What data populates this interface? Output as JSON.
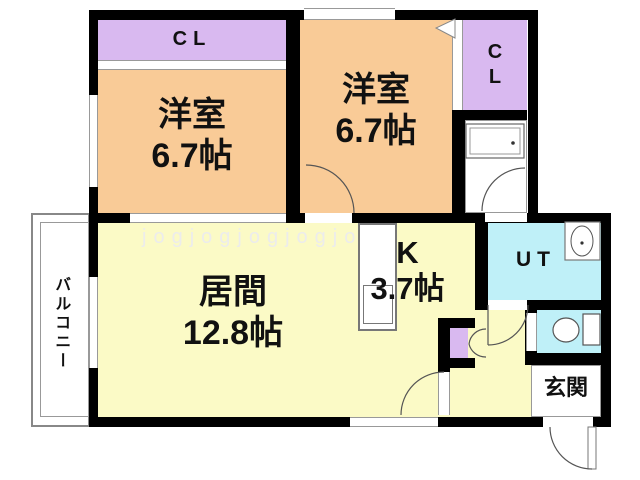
{
  "watermark": "jogjogjogjogjo",
  "rooms": {
    "closet_top": {
      "label": "CL"
    },
    "bedroom_left": {
      "name": "洋室",
      "size": "6.7帖"
    },
    "bedroom_right": {
      "name": "洋室",
      "size": "6.7帖"
    },
    "closet_right": {
      "line1": "C",
      "line2": "L"
    },
    "living": {
      "name": "居間",
      "size": "12.8帖"
    },
    "kitchen": {
      "name": "K",
      "size": "3.7帖"
    },
    "utility": {
      "label": "UT"
    },
    "entrance": {
      "label": "玄関"
    },
    "balcony": {
      "label": "バルコニー"
    }
  },
  "colors": {
    "room_orange": "#F9CB97",
    "closet_purple": "#D9B9F0",
    "living_yellow": "#FBFAC6",
    "wet_area_cyan": "#BFF0F8",
    "wall_black": "#000000",
    "line_gray": "#888888",
    "watermark_gray": "#ECECEC"
  }
}
